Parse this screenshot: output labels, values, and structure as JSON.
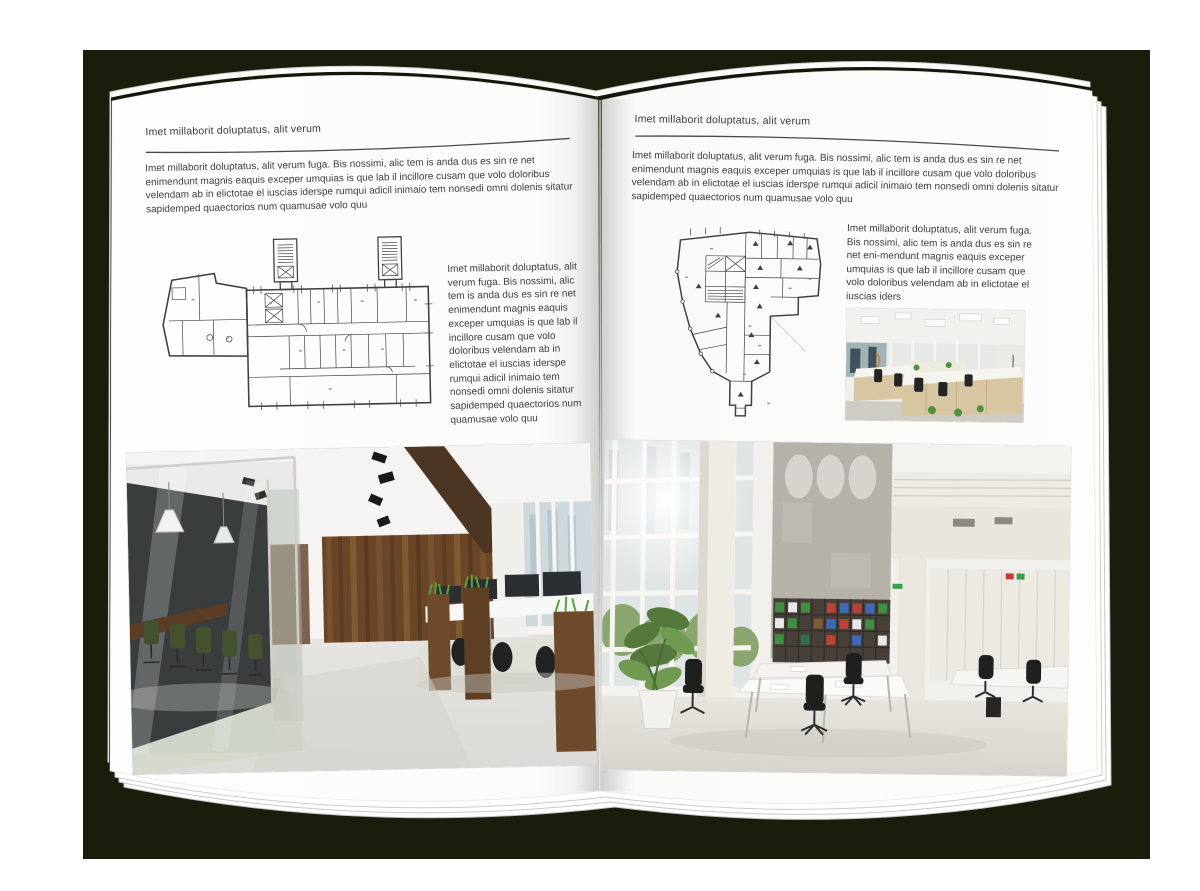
{
  "backdrop": {
    "color": "#1a1c0c"
  },
  "left_page": {
    "header": "Imet millaborit doluptatus, alit verum",
    "intro": "Imet millaborit doluptatus, alit verum fuga. Bis nossimi, alic tem is anda dus es sin re net enimendunt magnis eaquis exceper umquias is que lab il incillore cusam que volo doloribus velendam ab in elictotae el iuscias iderspe rumqui adicil inimaio tem nonsedi omni dolenis sitatur sapidemped quaectorios num quamusae volo quu",
    "side_text": "Imet millaborit doluptatus, alit verum fuga. Bis nossimi, alic tem is anda dus es sin re net enimendunt magnis eaquis exceper umquias is que lab il incillore cusam que volo doloribus velendam ab in elictotae el iuscias iderspe rumqui adicil inimaio tem nonsedi omni dolenis sitatur sapidemped quaectorios num quamusae volo quu",
    "figures": {
      "floor_plan": "architectural-floor-plan-rectangular-building",
      "photo": "office-interior-dark-glass-meeting-room-wood-wall"
    }
  },
  "right_page": {
    "header": "Imet millaborit doluptatus, alit verum",
    "intro": "Imet millaborit doluptatus, alit verum fuga. Bis nossimi, alic tem is anda dus es sin re net enimendunt magnis eaquis exceper umquias is que lab il incillore cusam que volo doloribus velendam ab in elictotae el iuscias iderspe rumqui adicil inimaio tem nonsedi omni dolenis sitatur sapidemped quaectorios num quamusae volo quu",
    "paragraph": "Imet millaborit doluptatus, alit verum fuga. Bis nossimi, alic tem is anda dus es sin re net eni-mendunt magnis eaquis exceper umquias is que lab il incillore cusam que volo doloribus velendam ab in elictotae el iuscias iders",
    "figures": {
      "floor_plan": "architectural-floor-plan-irregular-building",
      "photo_small": "bright-open-plan-office-desks",
      "photo_large": "tall-white-office-atrium-bookshelves"
    }
  }
}
